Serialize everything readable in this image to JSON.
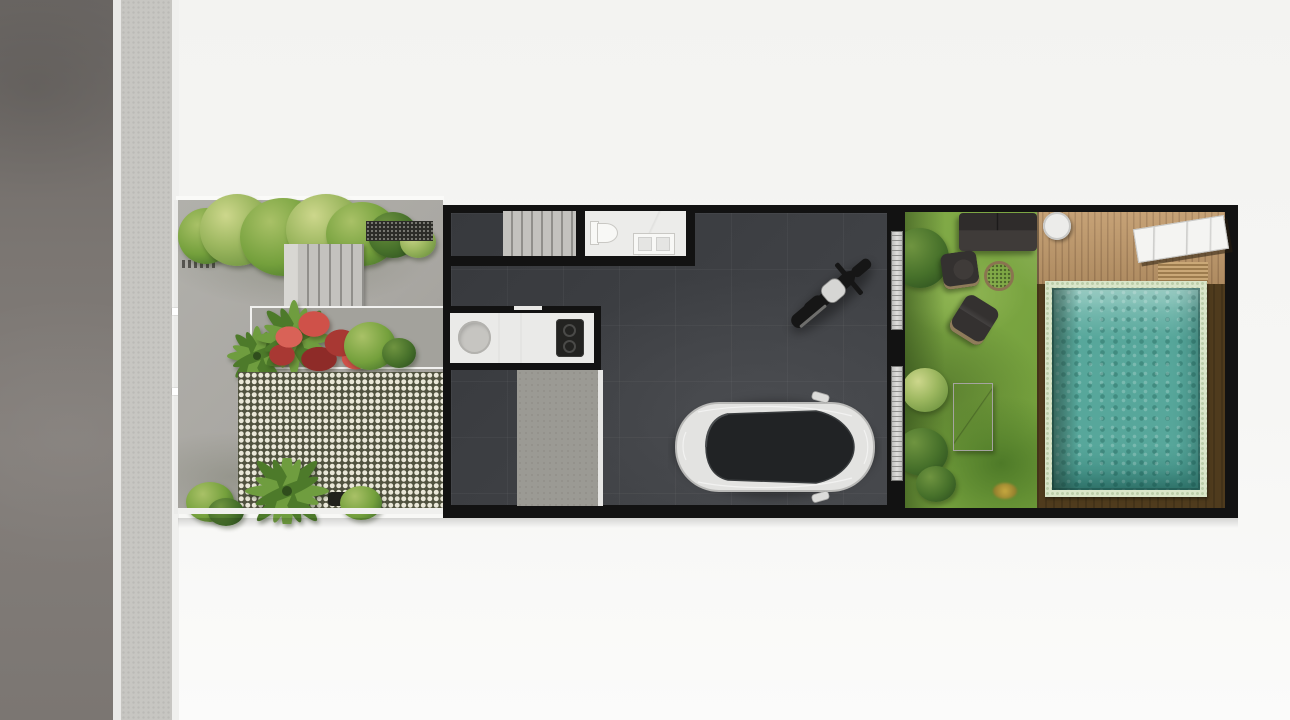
{
  "scene": {
    "type": "architectural-site-plan",
    "view": "top-down-render",
    "description": "Top-down render of a narrow row-house plot: street and sidewalk at left, front garden with entry steps and grass-block paving, dark-floored house volume with staircase, bathroom and kitchen, a parked motorcycle and car, and a rear garden with lawn, lounge furniture, timber deck and swimming pool."
  },
  "objects": {
    "street": "street",
    "sidewalk": "sidewalk",
    "front_gate": "front gate",
    "front_garden": "front garden paving",
    "entry_steps": "entry steps",
    "gravel_strip": "gravel strip",
    "planter": "planter bed",
    "red_shrub": "red flowering shrub",
    "palm": "palm plant",
    "shrub": "shrub",
    "grass_pavers": "grass-block paver driveway",
    "building": "house volume",
    "garage": "garage floor",
    "staircase": "staircase",
    "bathroom": "bathroom",
    "toilet": "toilet",
    "vanity": "vanity basin",
    "kitchen": "kitchen counter",
    "sink": "round kitchen sink",
    "cooktop": "cooktop",
    "apron": "garage apron",
    "motorcycle": "motorcycle",
    "car": "car",
    "sliding_door": "sliding glass door",
    "lawn": "back-garden lawn",
    "sofa": "outdoor sofa",
    "armchair": "outdoor armchair",
    "fire_pit": "fire pit",
    "lounge_chair": "lounge chair",
    "garden_table": "garden table",
    "deck": "timber deck",
    "deck_dark": "dark timber pool surround",
    "side_table": "round side table",
    "sun_bench": "stone sun bench",
    "pool": "swimming pool"
  },
  "palette": {
    "bg": "#f3f3f1",
    "road": "#7b7672",
    "road-dark": "#6a6663",
    "road-light": "#837e7a",
    "divider": "#e9e9e7",
    "sidewalk": "#c7c6c2",
    "curb": "#f0f0ee",
    "paving": "#b1b0ab",
    "paving-dark": "#9c9a94",
    "plan-edge": "#fafaf8",
    "gate": "#ebebe9",
    "gravel": "#2c2c28",
    "wall": "#121212",
    "floor": "#3f4145",
    "floor-light": "#4b4d51",
    "stairs": "#c3c2be",
    "stair-line": "#908f8b",
    "room": "#ececea",
    "fixture": "#f8f8f6",
    "fixture-line": "#c9c8c4",
    "counter": "#eaeae8",
    "sink": "#c6c5c1",
    "cooktop": "#232321",
    "checker-dark": "#50523f",
    "checker-light": "#e9e7d8",
    "apron": "#9b9a94",
    "sill": "#e7e7e5",
    "lawn": "#74a03c",
    "lawn-light": "#90b554",
    "lawn-dark": "#4e7a28",
    "hedge": "#46702a",
    "hedge-light": "#9cb75f",
    "deck": "#c29b6c",
    "deck-line": "#a8835a",
    "deck-dark": "#4f3b1d",
    "pool-tile": "#d9e5c9",
    "pool-dot": "#bcceaa",
    "water": "#57a79b",
    "water-light": "#8ec8be",
    "water-dark": "#3f8d82",
    "sofa": "#2f2c2b",
    "chair": "#343130",
    "cushion": "#3f3b39",
    "rattan": "#8f7c5a",
    "firepit": "#6f5d3f",
    "firepit-rim": "#8a7450",
    "marble": "#f4f4f2",
    "marble-line": "#c6c6c4",
    "tabletop": "#d1d0cd",
    "table-dark": "#2a2927",
    "car-body": "#e3e3e1",
    "car-shade": "#b9b9b7",
    "car-glass": "#212325",
    "moto": "#161616",
    "moto-tank": "#d6d6d4",
    "red1": "#cf5149",
    "red2": "#a83833",
    "green-leaf": "#6f9d3f",
    "green-leaf-dark": "#4d7a2a"
  }
}
